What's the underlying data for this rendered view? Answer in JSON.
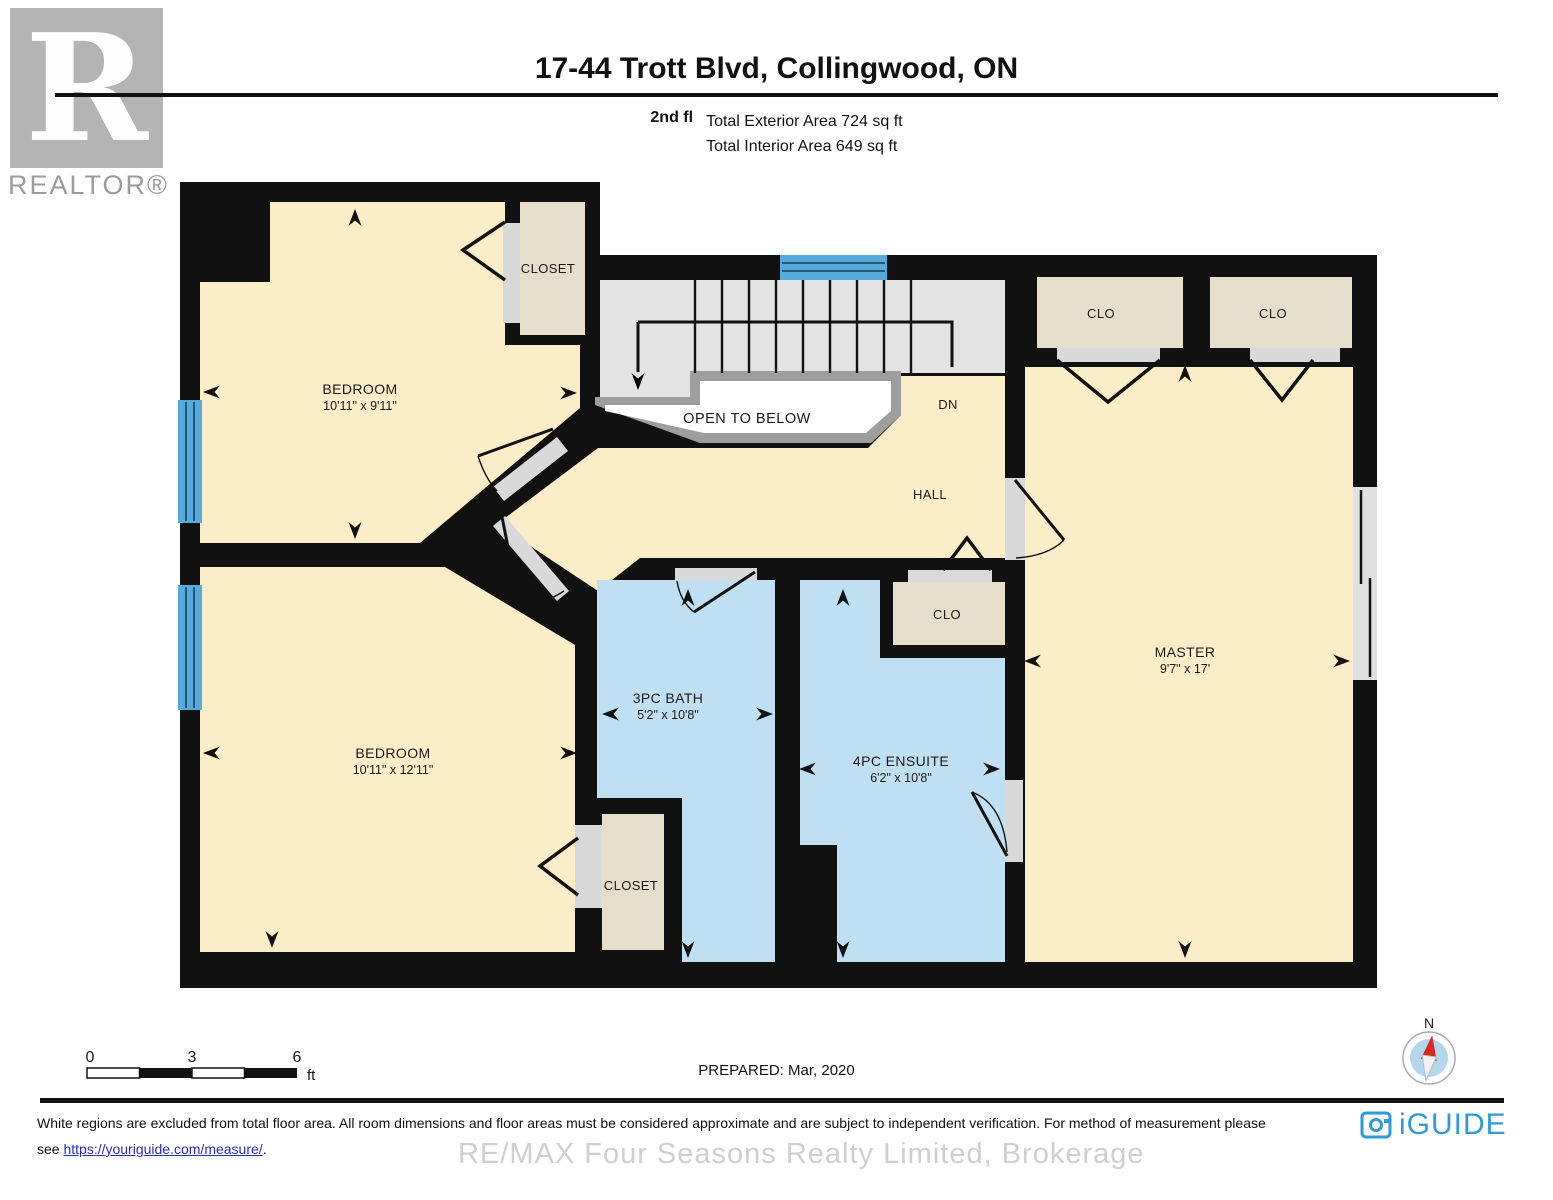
{
  "header": {
    "logo_letter": "R",
    "logo_brand": "REALTOR®",
    "title": "17-44 Trott Blvd, Collingwood, ON",
    "floor_label": "2nd fl",
    "exterior_area": "Total Exterior Area 724 sq ft",
    "interior_area": "Total Interior Area 649 sq ft"
  },
  "rooms": {
    "bedroom1": {
      "name": "BEDROOM",
      "dims": "10'11\" x 9'11\""
    },
    "bedroom2": {
      "name": "BEDROOM",
      "dims": "10'11\" x 12'11\""
    },
    "master": {
      "name": "MASTER",
      "dims": "9'7\" x 17'"
    },
    "bath": {
      "name": "3PC BATH",
      "dims": "5'2\" x 10'8\""
    },
    "ensuite": {
      "name": "4PC ENSUITE",
      "dims": "6'2\" x 10'8\""
    },
    "closet_top": {
      "name": "CLOSET"
    },
    "closet_bottom": {
      "name": "CLOSET"
    },
    "clo_master_left": {
      "name": "CLO"
    },
    "clo_master_right": {
      "name": "CLO"
    },
    "clo_hall": {
      "name": "CLO"
    },
    "hall": {
      "name": "HALL"
    },
    "stairs_direction": {
      "name": "DN"
    },
    "open_to_below": {
      "name": "OPEN TO BELOW"
    }
  },
  "scale_bar": {
    "start": "0",
    "mid": "3",
    "end": "6",
    "unit": "ft"
  },
  "prepared": "PREPARED: Mar, 2020",
  "compass": {
    "north_label": "N"
  },
  "footer": {
    "disclaimer_line1": "White regions are excluded from total floor area. All room dimensions and floor areas must be considered approximate and are subject to independent verification. For method of measurement please",
    "disclaimer_line2_prefix": "see ",
    "disclaimer_link": "https://youriguide.com/measure/",
    "disclaimer_suffix": ".",
    "watermark": "RE/MAX Four Seasons Realty Limited, Brokerage",
    "brand": "iGUIDE"
  },
  "colors": {
    "wall": "#111111",
    "room_cream": "#FAEDC8",
    "closet_tan": "#E6DECA",
    "bath_blue": "#BFE0F2",
    "window_blue": "#57ABDC",
    "stairs_gray": "#E3E3E3",
    "brand_blue": "#2E9BD6",
    "link_blue": "#2A2AC9",
    "compass_needle_red": "#D42B1E"
  }
}
